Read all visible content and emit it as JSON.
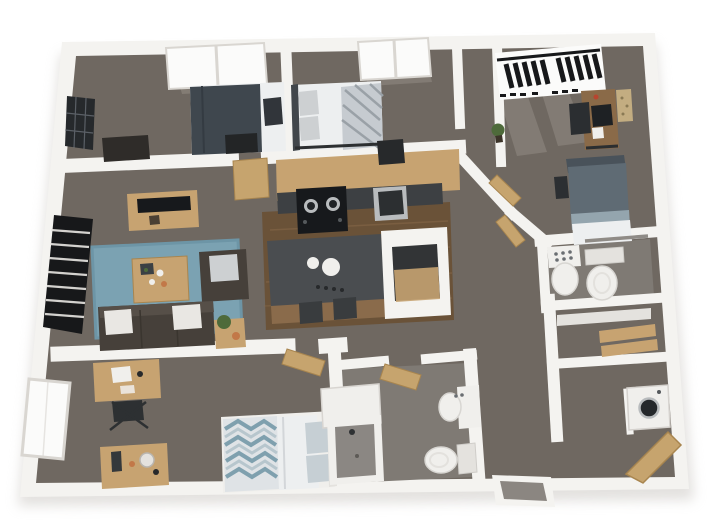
{
  "scene": {
    "type": "3d-floor-plan-render",
    "view": "top-down isometric",
    "units": "none",
    "rooms": [
      {
        "name": "bedroom-top-left",
        "furniture": [
          "double-window",
          "wall-art-dark",
          "dark-desk",
          "bed-dark-slate-duvet",
          "foot-bench",
          "dark-pillow"
        ]
      },
      {
        "name": "bedroom-top-middle",
        "furniture": [
          "window",
          "bed-patterned-duvet",
          "gray-pillows",
          "dark-chair"
        ]
      },
      {
        "name": "bedroom-top-right",
        "furniture": [
          "blinds-window",
          "desk-with-monitor",
          "desk-chair",
          "pinboard",
          "plant",
          "bed-gray-blue-duvet",
          "nightstand"
        ]
      },
      {
        "name": "living-room",
        "furniture": [
          "blinds-window",
          "media-console",
          "tv",
          "blue-area-rug",
          "coffee-table",
          "armchair",
          "sofa-with-pillows",
          "side-table-with-plant"
        ]
      },
      {
        "name": "kitchen",
        "furniture": [
          "cabinet-run",
          "cooktop",
          "stainless-sink",
          "island-with-plates",
          "bar-stools",
          "pantry-box"
        ]
      },
      {
        "name": "hall-center",
        "furniture": [
          "angled-walls",
          "open-door-bedroom",
          "open-door-bathroom"
        ]
      },
      {
        "name": "bathroom-right",
        "furniture": [
          "pedestal-sink",
          "toilet",
          "mirror-shelf"
        ]
      },
      {
        "name": "closet-right",
        "furniture": [
          "white-shelf",
          "wood-shelves"
        ]
      },
      {
        "name": "laundry-nook",
        "furniture": [
          "washer"
        ]
      },
      {
        "name": "entry",
        "furniture": [
          "open-entry-door",
          "exterior-step"
        ]
      },
      {
        "name": "bedroom-bottom-left",
        "furniture": [
          "window",
          "desk-with-laptop",
          "desk-chair",
          "dresser-with-mirror",
          "bed-chevron-duvet",
          "open-door"
        ]
      },
      {
        "name": "bathroom-bottom",
        "furniture": [
          "vanity",
          "shower-stall",
          "basin-sink",
          "toilet",
          "open-door"
        ]
      }
    ]
  },
  "palette": {
    "background": "#ffffff",
    "shadow": "#c7c3be",
    "wall": "#f4f3f0",
    "wallShade": "#d9d6d1",
    "carpet": "#6f6861",
    "bathFloor": "#7f7a74",
    "showerFloor": "#8b8783",
    "notchFloor": "#8b8681",
    "lightPool": "#9b948b",
    "wood": "#6a5238",
    "woodLight": "#8a6b4b",
    "cabinetTan": "#c7a371",
    "counterDark": "#3d4043",
    "applianceBlack": "#17191c",
    "stainless": "#b9bcbe",
    "stainlessDark": "#2c2f31",
    "islandTop": "#4a4d50",
    "white": "#f0efec",
    "offWhite": "#e4e2de",
    "glass": "#fbfbfa",
    "rugBlue": "#7ba2b2",
    "rugBlueDark": "#6d95a6",
    "sofaDark": "#46403a",
    "sofaBack": "#564f48",
    "pillowWhite": "#e9e7e3",
    "pillowGray": "#cdd0d2",
    "furnDark": "#27292b",
    "furnBrownDark": "#2f2c29",
    "duvetSlate": "#3f474e",
    "bedWhite": "#edeff0",
    "duvetPattern": "#c6cbd0",
    "patternStripe": "#9aa1a7",
    "duvetC": "#5f6b74",
    "duvetCMid": "#94a5ae",
    "headboardC": "#49525a",
    "deskWood": "#8a6a48",
    "doorTan": "#c6a46e",
    "doorTanDark": "#a8854f",
    "plantGreen": "#4e6a3a",
    "potBrown": "#3c3429",
    "accentOrange": "#c27848",
    "accentRed": "#b8452f",
    "chevBlue": "#7fa0ae",
    "chevLight": "#b7c6cd",
    "blindDark": "#17181a",
    "artDark": "#26292c"
  }
}
